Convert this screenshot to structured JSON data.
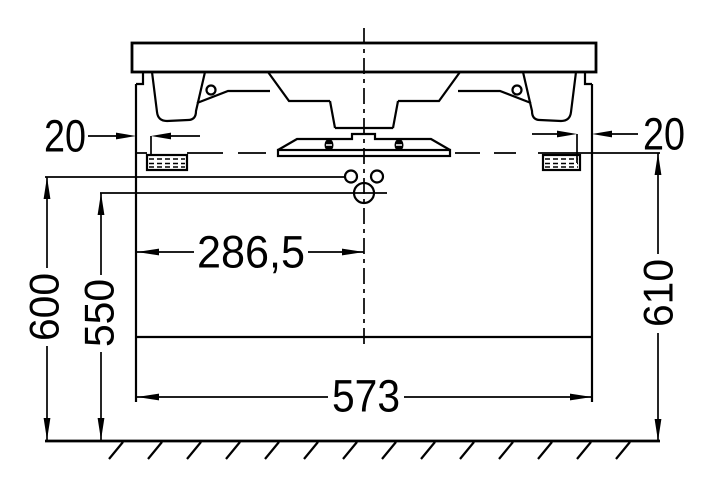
{
  "drawing": {
    "kind": "vanity-unit-front-elevation",
    "background": "#ffffff",
    "line_color": "#000000",
    "dimensions": {
      "left_side_offset": "20",
      "right_side_offset": "20",
      "center_to_left_edge": "286,5",
      "cabinet_width": "573",
      "height_left_outer": "600",
      "height_left_inner": "550",
      "height_right": "610"
    }
  }
}
